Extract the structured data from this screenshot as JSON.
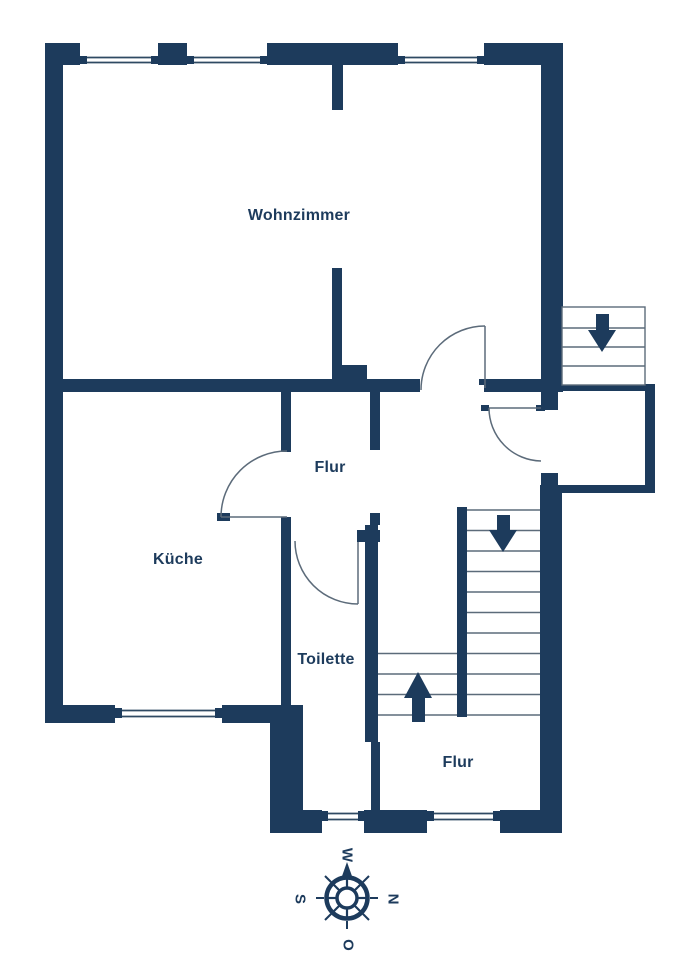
{
  "colors": {
    "wall": "#1d3b5c",
    "text": "#1d3b5c",
    "line": "#5c6b7a",
    "window_line": "#2f4a63",
    "background": "#ffffff"
  },
  "rooms": [
    {
      "id": "wohnzimmer",
      "label": "Wohnzimmer"
    },
    {
      "id": "flur_mitte",
      "label": "Flur"
    },
    {
      "id": "kueche",
      "label": "Küche"
    },
    {
      "id": "toilette",
      "label": "Toilette"
    },
    {
      "id": "flur_unten",
      "label": "Flur"
    }
  ],
  "compass": {
    "top": "W",
    "right": "N",
    "left": "S",
    "bottom": "O"
  },
  "icons": {
    "interior_stairs_down": "down-arrow",
    "interior_stairs_up": "up-arrow",
    "exterior_stairs_down": "down-arrow",
    "compass": "compass-rose"
  }
}
